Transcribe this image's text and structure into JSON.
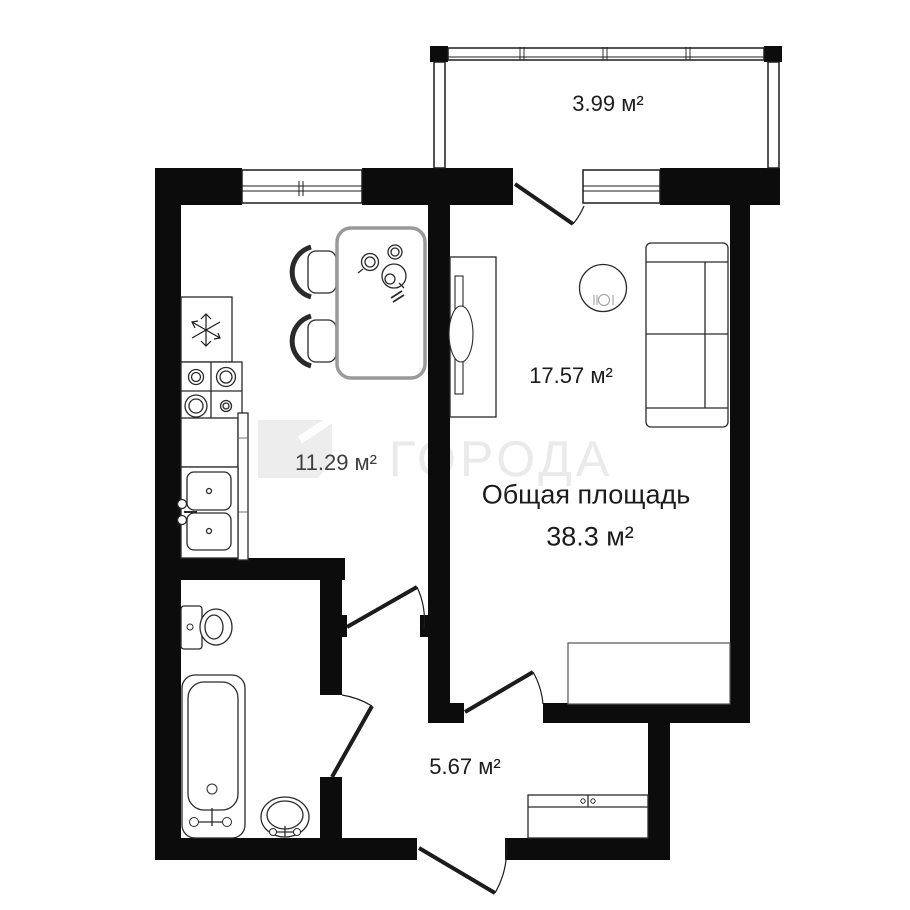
{
  "watermark": {
    "text": "ГОРОДА"
  },
  "labels": {
    "balcony": "3.99 м²",
    "kitchen": "11.29 м²",
    "living": "17.57 м²",
    "hallway": "5.67 м²",
    "total_title": "Общая площадь",
    "total_area": "38.3 м²"
  },
  "colors": {
    "wall": "#0c0c0c",
    "furniture_line": "#2a2a2a",
    "watermark": "#eaeaea"
  }
}
